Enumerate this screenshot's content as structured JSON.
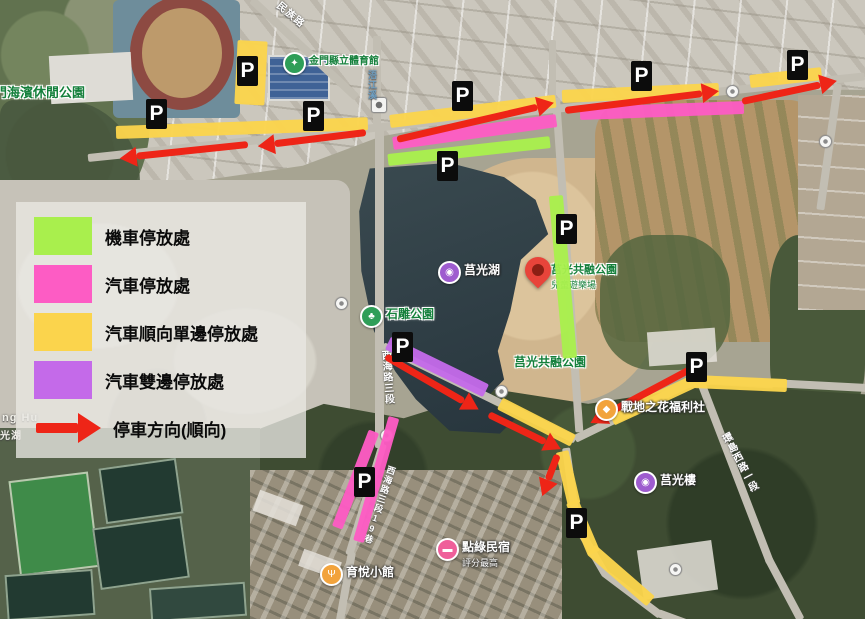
{
  "legend": {
    "items": [
      {
        "id": "motorcycle-parking",
        "label": "機車停放處",
        "color": "#a9ef4d",
        "icon": "swatch"
      },
      {
        "id": "car-parking",
        "label": "汽車停放處",
        "color": "#fd5cc4",
        "icon": "swatch"
      },
      {
        "id": "car-oneway-single-side-parking",
        "label": "汽車順向單邊停放處",
        "color": "#fbd44c",
        "icon": "swatch"
      },
      {
        "id": "car-both-sides-parking",
        "label": "汽車雙邊停放處",
        "color": "#c46ae9",
        "icon": "swatch"
      },
      {
        "id": "parking-direction",
        "label": "停車方向(順向)",
        "color": "#ee2517",
        "icon": "arrow-right"
      }
    ]
  },
  "annotations": {
    "p_marker_letter": "P",
    "p_markers": [
      {
        "x": 146,
        "y": 99
      },
      {
        "x": 237,
        "y": 56
      },
      {
        "x": 303,
        "y": 101
      },
      {
        "x": 452,
        "y": 81
      },
      {
        "x": 437,
        "y": 151
      },
      {
        "x": 631,
        "y": 61
      },
      {
        "x": 787,
        "y": 50
      },
      {
        "x": 556,
        "y": 214
      },
      {
        "x": 392,
        "y": 332
      },
      {
        "x": 354,
        "y": 467
      },
      {
        "x": 686,
        "y": 352
      },
      {
        "x": 566,
        "y": 508
      }
    ],
    "zone_colors": {
      "motorcycle": "#a9ef4d",
      "car": "#fd5cc4",
      "car_oneway": "#fbd44c",
      "car_both_sides": "#c46ae9",
      "direction_arrow": "#ee2517"
    }
  },
  "map": {
    "pois": [
      {
        "id": "seaside-leisure-park",
        "label": "門海濱休閒公園",
        "type": "label",
        "label_style": "green",
        "x": -6,
        "y": 82,
        "size": 13
      },
      {
        "id": "county-stadium",
        "label": "金門縣立體育館",
        "type": "poi",
        "icon": "sports",
        "icon_color": "#2f9e58",
        "label_style": "green",
        "x": 283,
        "y": 52,
        "size": 10
      },
      {
        "id": "juguang-lake",
        "label": "莒光湖",
        "type": "poi",
        "icon": "camera",
        "icon_color": "#9e5ccf",
        "label_style": "white",
        "x": 438,
        "y": 261,
        "size": 12
      },
      {
        "id": "juguang-inclusive-park-north",
        "label": "莒光共融公園",
        "sub": "兒童遊樂場",
        "type": "label",
        "label_style": "green",
        "x": 551,
        "y": 261,
        "size": 11
      },
      {
        "id": "stone-sculpture-park",
        "label": "石雕公園",
        "type": "poi",
        "icon": "tree",
        "icon_color": "#2f9e58",
        "label_style": "green",
        "x": 360,
        "y": 305,
        "size": 12
      },
      {
        "id": "juguang-inclusive-park-south",
        "label": "莒光共融公園",
        "type": "label",
        "label_style": "green",
        "x": 514,
        "y": 353,
        "size": 12
      },
      {
        "id": "battlefield-flower-welfare-shop",
        "label": "戰地之花福利社",
        "type": "poi",
        "icon": "shop",
        "icon_color": "#f2a33c",
        "label_style": "white",
        "x": 595,
        "y": 398,
        "size": 12
      },
      {
        "id": "juguang-tower",
        "label": "莒光樓",
        "type": "poi",
        "icon": "camera",
        "icon_color": "#9e5ccf",
        "label_style": "white",
        "x": 634,
        "y": 471,
        "size": 12
      },
      {
        "id": "dianlv-bnb",
        "label": "點綠民宿",
        "sub": "評分最高",
        "type": "poi",
        "icon": "bed",
        "icon_color": "#ef5f9a",
        "label_style": "white",
        "x": 436,
        "y": 538,
        "size": 12
      },
      {
        "id": "yuyue-restaurant",
        "label": "育悅小館",
        "type": "poi",
        "icon": "restaurant",
        "icon_color": "#f2a33c",
        "label_style": "white",
        "x": 320,
        "y": 563,
        "size": 12
      },
      {
        "id": "destination-pin",
        "label": "",
        "type": "pin",
        "x": 525,
        "y": 257
      }
    ],
    "road_labels": [
      {
        "text": "民族路",
        "x": 280,
        "y": 8,
        "vertical": false,
        "rot": 40,
        "color": "#ffffff",
        "size": 10
      },
      {
        "text": "浯江溪",
        "x": 366,
        "y": 70,
        "vertical": true,
        "rot": 0,
        "color": "#6e9fc2",
        "size": 9
      },
      {
        "text": "西海路三段",
        "x": 377,
        "y": 350,
        "vertical": true,
        "rot": -4,
        "color": "#ffffff",
        "size": 10
      },
      {
        "text": "西海路三段19巷",
        "x": 386,
        "y": 466,
        "vertical": true,
        "rot": 18,
        "color": "#ffffff",
        "size": 9
      },
      {
        "text": "環島西路一段",
        "x": 716,
        "y": 434,
        "vertical": true,
        "rot": -28,
        "color": "#ffffff",
        "size": 10
      },
      {
        "text": "ng Hu",
        "x": 2,
        "y": 412,
        "vertical": false,
        "rot": 0,
        "color": "#f2f1ea",
        "size": 11
      },
      {
        "text": "光湖",
        "x": 0,
        "y": 427,
        "vertical": false,
        "rot": 0,
        "color": "#f2f1ea",
        "size": 10
      }
    ],
    "junction_icons": [
      {
        "x": 371,
        "y": 97,
        "shape": "square"
      },
      {
        "x": 726,
        "y": 85,
        "shape": "circle"
      },
      {
        "x": 819,
        "y": 135,
        "shape": "circle"
      },
      {
        "x": 495,
        "y": 385,
        "shape": "circle"
      },
      {
        "x": 380,
        "y": 429,
        "shape": "circle"
      },
      {
        "x": 669,
        "y": 563,
        "shape": "circle"
      },
      {
        "x": 335,
        "y": 297,
        "shape": "circle"
      }
    ]
  }
}
